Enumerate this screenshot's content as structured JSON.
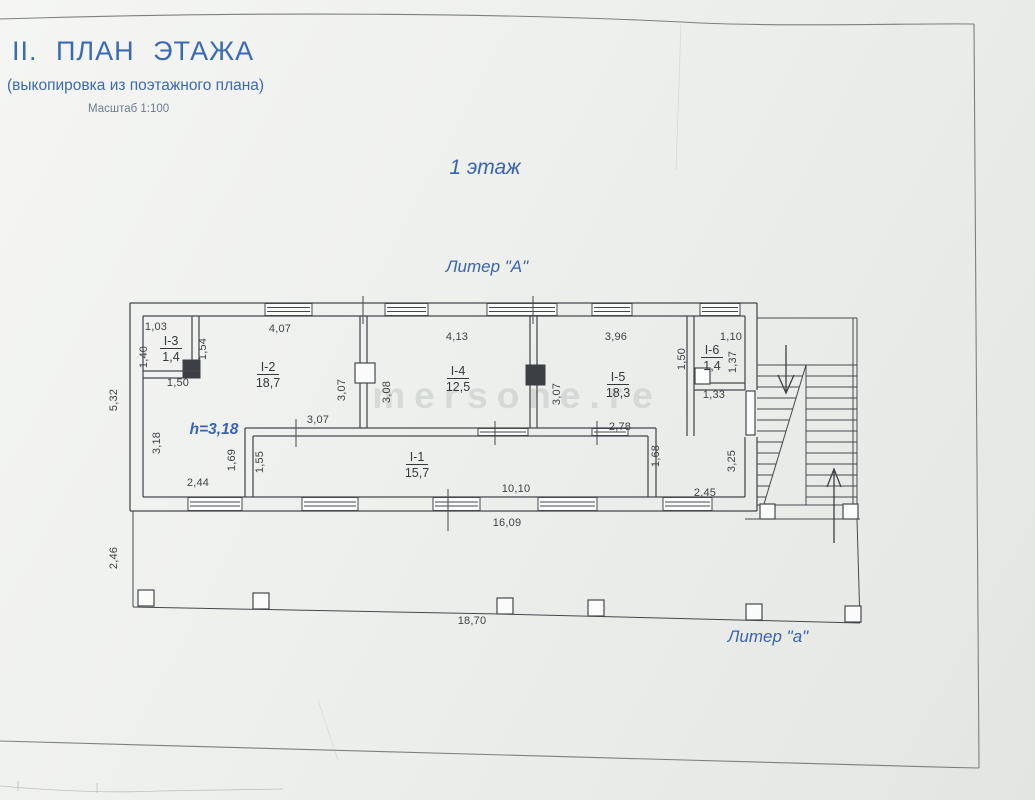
{
  "page": {
    "title": "II. ПЛАН ЭТАЖА",
    "subtitle": "(выкопировка из поэтажного плана)",
    "scale_note": "Масштаб 1:100",
    "floor_label": "1 этаж",
    "building_label": "Литер \"А\"",
    "annex_label": "Литер \"а\"",
    "ceiling_height_label": "h=3,18",
    "watermark": "mersone.re"
  },
  "colors": {
    "accent_blue": "#3a6ab4",
    "line": "#45484c",
    "dim_text": "#3f4246",
    "paper": "#eef0ee"
  },
  "rooms": [
    {
      "id": "I-2",
      "area": "18,7",
      "x": 268,
      "y": 371
    },
    {
      "id": "I-3",
      "area": "1,4",
      "x": 171,
      "y": 345
    },
    {
      "id": "I-4",
      "area": "12,5",
      "x": 458,
      "y": 375
    },
    {
      "id": "I-5",
      "area": "18,3",
      "x": 618,
      "y": 381
    },
    {
      "id": "I-6",
      "area": "1,4",
      "x": 712,
      "y": 354
    },
    {
      "id": "I-1",
      "area": "15,7",
      "x": 417,
      "y": 461
    }
  ],
  "dimensions": [
    {
      "text": "1,03",
      "x": 156,
      "y": 330,
      "rot": 0
    },
    {
      "text": "4,07",
      "x": 280,
      "y": 332,
      "rot": 0
    },
    {
      "text": "4,13",
      "x": 457,
      "y": 340,
      "rot": 0
    },
    {
      "text": "3,96",
      "x": 616,
      "y": 340,
      "rot": 0
    },
    {
      "text": "1,10",
      "x": 731,
      "y": 340,
      "rot": 0
    },
    {
      "text": "1,50",
      "x": 178,
      "y": 386,
      "rot": 0
    },
    {
      "text": "1,33",
      "x": 714,
      "y": 398,
      "rot": 0
    },
    {
      "text": "3,07",
      "x": 318,
      "y": 423,
      "rot": 0
    },
    {
      "text": "2,78",
      "x": 620,
      "y": 430,
      "rot": 0
    },
    {
      "text": "2,44",
      "x": 198,
      "y": 486,
      "rot": 0
    },
    {
      "text": "10,10",
      "x": 516,
      "y": 492,
      "rot": 0
    },
    {
      "text": "2,45",
      "x": 705,
      "y": 496,
      "rot": 0
    },
    {
      "text": "16,09",
      "x": 507,
      "y": 526,
      "rot": 0
    },
    {
      "text": "18,70",
      "x": 472,
      "y": 624,
      "rot": 0
    },
    {
      "text": "1,40",
      "x": 147,
      "y": 357,
      "rot": 90
    },
    {
      "text": "1,54",
      "x": 206,
      "y": 349,
      "rot": 90
    },
    {
      "text": "5,32",
      "x": 117,
      "y": 400,
      "rot": 90
    },
    {
      "text": "3,18",
      "x": 160,
      "y": 443,
      "rot": 90
    },
    {
      "text": "3,07",
      "x": 345,
      "y": 390,
      "rot": 90
    },
    {
      "text": "3,08",
      "x": 390,
      "y": 392,
      "rot": 90
    },
    {
      "text": "3,07",
      "x": 560,
      "y": 394,
      "rot": 90
    },
    {
      "text": "1,50",
      "x": 685,
      "y": 359,
      "rot": 90
    },
    {
      "text": "1,37",
      "x": 736,
      "y": 362,
      "rot": 90
    },
    {
      "text": "1,69",
      "x": 235,
      "y": 460,
      "rot": 90
    },
    {
      "text": "1,55",
      "x": 263,
      "y": 462,
      "rot": 90
    },
    {
      "text": "1,68",
      "x": 659,
      "y": 456,
      "rot": 90
    },
    {
      "text": "3,25",
      "x": 735,
      "y": 461,
      "rot": 90
    },
    {
      "text": "2,46",
      "x": 117,
      "y": 558,
      "rot": 90
    }
  ]
}
